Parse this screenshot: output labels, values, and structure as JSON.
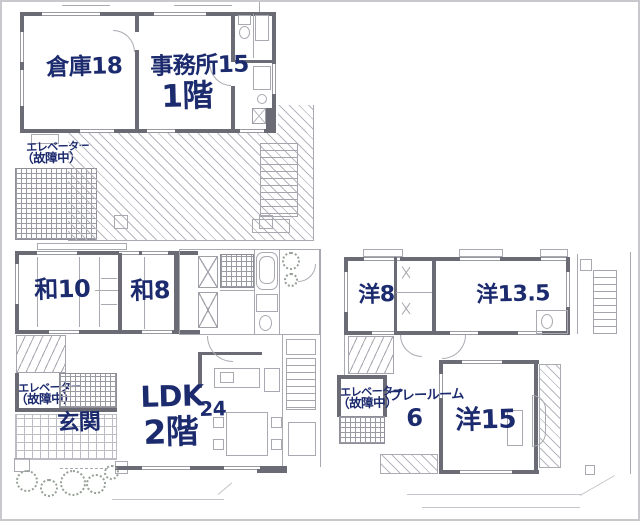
{
  "colors": {
    "ink": "#1c2a6e",
    "wall": "#6b6b75",
    "thin_line": "#a9a9b1",
    "background": "#ffffff",
    "frame": "#c9c9cd"
  },
  "floor1": {
    "warehouse": "倉庫18",
    "office": "事務所15",
    "floor": "1階",
    "elev1": "エレベーター",
    "elev2": "（故障中）"
  },
  "floor2": {
    "jp10": "和10",
    "jp8": "和8",
    "ldk": "LDK",
    "ldk_size": "24",
    "floor": "2階",
    "entrance": "玄関",
    "elev1": "エレベーター",
    "elev2": "（故障中）"
  },
  "floor3": {
    "west8": "洋8",
    "west13_5": "洋13.5",
    "playroom": "プレールーム",
    "playroom_size": "6",
    "west15": "洋15",
    "elev1": "エレベーター",
    "elev2": "（故障中）"
  }
}
